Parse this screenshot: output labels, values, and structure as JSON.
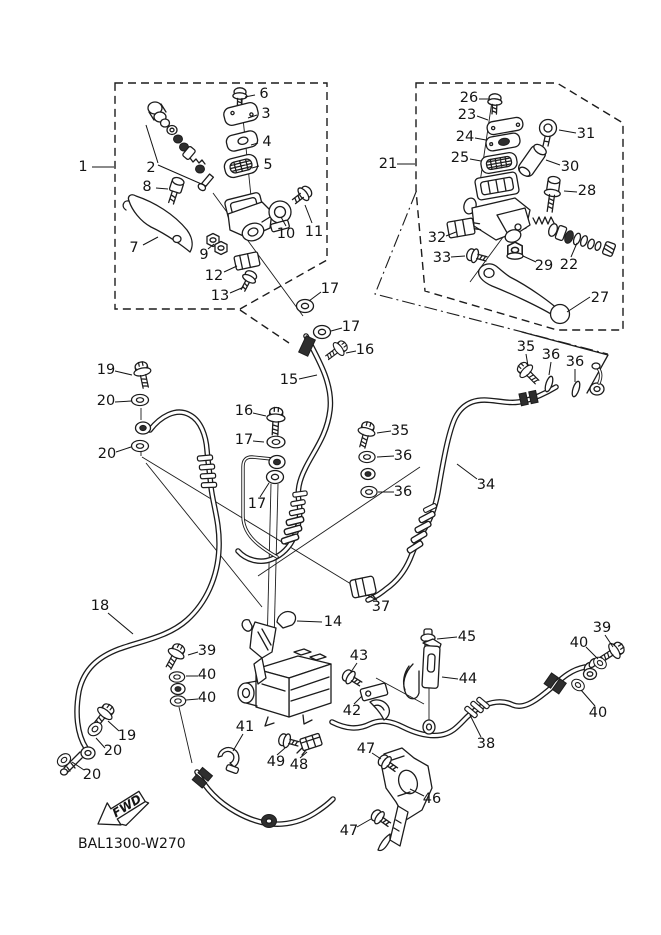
{
  "diagram": {
    "code_label": "BAL1300-W270",
    "fwd_arrow": {
      "label": "FWD"
    },
    "colors": {
      "background": "#ffffff",
      "line": "#1c1c1c",
      "text": "#141414"
    },
    "part_labels": [
      {
        "text": "1",
        "x": 83,
        "y": 167,
        "l": [
          [
            92,
            167,
            114,
            167
          ]
        ]
      },
      {
        "text": "2",
        "x": 151,
        "y": 168,
        "l": [
          [
            158,
            163,
            146,
            125
          ],
          [
            158,
            165,
            206,
            186
          ]
        ]
      },
      {
        "text": "3",
        "x": 266,
        "y": 114,
        "l": [
          [
            257,
            115,
            248,
            118
          ]
        ]
      },
      {
        "text": "4",
        "x": 267,
        "y": 142,
        "l": [
          [
            258,
            143,
            251,
            145
          ]
        ]
      },
      {
        "text": "5",
        "x": 268,
        "y": 165,
        "l": [
          [
            259,
            166,
            252,
            168
          ]
        ]
      },
      {
        "text": "6",
        "x": 264,
        "y": 94,
        "l": [
          [
            255,
            95,
            245,
            97
          ]
        ]
      },
      {
        "text": "7",
        "x": 134,
        "y": 248,
        "l": [
          [
            143,
            245,
            158,
            237
          ]
        ]
      },
      {
        "text": "8",
        "x": 147,
        "y": 187,
        "l": [
          [
            156,
            188,
            168,
            189
          ]
        ]
      },
      {
        "text": "9",
        "x": 204,
        "y": 255,
        "l": [
          [
            208,
            249,
            214,
            244
          ]
        ]
      },
      {
        "text": "10",
        "x": 286,
        "y": 234,
        "l": [
          [
            286,
            226,
            281,
            217
          ]
        ]
      },
      {
        "text": "11",
        "x": 314,
        "y": 232,
        "l": [
          [
            312,
            223,
            305,
            205
          ]
        ]
      },
      {
        "text": "12",
        "x": 214,
        "y": 276,
        "l": [
          [
            224,
            272,
            237,
            266
          ]
        ]
      },
      {
        "text": "13",
        "x": 220,
        "y": 296,
        "l": [
          [
            230,
            293,
            244,
            287
          ]
        ]
      },
      {
        "text": "17",
        "x": 330,
        "y": 289,
        "l": [
          [
            321,
            292,
            309,
            301
          ]
        ]
      },
      {
        "text": "17",
        "x": 351,
        "y": 327,
        "l": [
          [
            342,
            328,
            331,
            331
          ]
        ]
      },
      {
        "text": "16",
        "x": 365,
        "y": 350,
        "l": [
          [
            356,
            351,
            346,
            353
          ]
        ]
      },
      {
        "text": "15",
        "x": 289,
        "y": 380,
        "l": [
          [
            299,
            379,
            317,
            375
          ]
        ]
      },
      {
        "text": "21",
        "x": 388,
        "y": 164,
        "l": [
          [
            397,
            164,
            415,
            164
          ]
        ]
      },
      {
        "text": "26",
        "x": 469,
        "y": 98,
        "l": [
          [
            479,
            99,
            489,
            99
          ]
        ]
      },
      {
        "text": "23",
        "x": 467,
        "y": 115,
        "l": [
          [
            477,
            116,
            488,
            120
          ]
        ]
      },
      {
        "text": "24",
        "x": 465,
        "y": 137,
        "l": [
          [
            475,
            138,
            486,
            140
          ]
        ]
      },
      {
        "text": "25",
        "x": 460,
        "y": 158,
        "l": [
          [
            470,
            159,
            481,
            161
          ]
        ]
      },
      {
        "text": "31",
        "x": 586,
        "y": 134,
        "l": [
          [
            576,
            133,
            559,
            130
          ]
        ]
      },
      {
        "text": "30",
        "x": 570,
        "y": 167,
        "l": [
          [
            560,
            165,
            546,
            160
          ]
        ]
      },
      {
        "text": "28",
        "x": 587,
        "y": 191,
        "l": [
          [
            577,
            192,
            564,
            191
          ]
        ]
      },
      {
        "text": "32",
        "x": 437,
        "y": 238,
        "l": [
          [
            446,
            236,
            456,
            232
          ]
        ]
      },
      {
        "text": "33",
        "x": 442,
        "y": 258,
        "l": [
          [
            451,
            257,
            465,
            256
          ]
        ]
      },
      {
        "text": "29",
        "x": 544,
        "y": 266,
        "l": [
          [
            536,
            262,
            523,
            256
          ]
        ]
      },
      {
        "text": "22",
        "x": 569,
        "y": 265,
        "l": [
          [
            571,
            257,
            577,
            243
          ]
        ]
      },
      {
        "text": "27",
        "x": 600,
        "y": 298,
        "l": [
          [
            590,
            297,
            567,
            312
          ]
        ]
      },
      {
        "text": "35",
        "x": 526,
        "y": 347,
        "l": [
          [
            526,
            354,
            528,
            366
          ]
        ]
      },
      {
        "text": "36",
        "x": 551,
        "y": 355,
        "l": [
          [
            551,
            362,
            549,
            375
          ]
        ]
      },
      {
        "text": "36",
        "x": 575,
        "y": 362,
        "l": [
          [
            575,
            369,
            575,
            382
          ]
        ]
      },
      {
        "text": "34",
        "x": 486,
        "y": 485,
        "l": [
          [
            477,
            479,
            457,
            464
          ]
        ]
      },
      {
        "text": "19",
        "x": 106,
        "y": 370,
        "l": [
          [
            115,
            371,
            132,
            375
          ]
        ]
      },
      {
        "text": "20",
        "x": 106,
        "y": 401,
        "l": [
          [
            115,
            402,
            132,
            401
          ]
        ]
      },
      {
        "text": "20",
        "x": 107,
        "y": 454,
        "l": [
          [
            116,
            452,
            131,
            447
          ]
        ]
      },
      {
        "text": "16",
        "x": 244,
        "y": 411,
        "l": [
          [
            253,
            413,
            266,
            416
          ]
        ]
      },
      {
        "text": "17",
        "x": 244,
        "y": 440,
        "l": [
          [
            253,
            441,
            264,
            442
          ]
        ]
      },
      {
        "text": "17",
        "x": 257,
        "y": 504,
        "l": [
          [
            260,
            497,
            269,
            483
          ]
        ]
      },
      {
        "text": "35",
        "x": 400,
        "y": 431,
        "l": [
          [
            391,
            431,
            377,
            433
          ]
        ]
      },
      {
        "text": "36",
        "x": 403,
        "y": 456,
        "l": [
          [
            394,
            456,
            377,
            457
          ]
        ]
      },
      {
        "text": "36",
        "x": 403,
        "y": 492,
        "l": [
          [
            394,
            492,
            378,
            492
          ]
        ]
      },
      {
        "text": "18",
        "x": 100,
        "y": 606,
        "l": [
          [
            108,
            613,
            133,
            634
          ]
        ]
      },
      {
        "text": "37",
        "x": 381,
        "y": 607,
        "l": [
          [
            377,
            600,
            367,
            595
          ]
        ]
      },
      {
        "text": "14",
        "x": 333,
        "y": 622,
        "l": [
          [
            322,
            622,
            297,
            621
          ]
        ]
      },
      {
        "text": "39",
        "x": 207,
        "y": 651,
        "l": [
          [
            198,
            652,
            188,
            655
          ]
        ]
      },
      {
        "text": "40",
        "x": 207,
        "y": 675,
        "l": [
          [
            198,
            676,
            186,
            676
          ]
        ]
      },
      {
        "text": "40",
        "x": 207,
        "y": 698,
        "l": [
          [
            198,
            699,
            186,
            700
          ]
        ]
      },
      {
        "text": "19",
        "x": 127,
        "y": 736,
        "l": [
          [
            119,
            731,
            108,
            721
          ]
        ]
      },
      {
        "text": "20",
        "x": 113,
        "y": 751,
        "l": [
          [
            105,
            748,
            96,
            738
          ]
        ]
      },
      {
        "text": "20",
        "x": 92,
        "y": 775,
        "l": [
          [
            84,
            770,
            72,
            762
          ]
        ]
      },
      {
        "text": "41",
        "x": 245,
        "y": 727,
        "l": [
          [
            243,
            734,
            233,
            751
          ]
        ]
      },
      {
        "text": "49",
        "x": 276,
        "y": 762,
        "l": [
          [
            277,
            755,
            285,
            748
          ]
        ]
      },
      {
        "text": "48",
        "x": 299,
        "y": 765,
        "l": [
          [
            300,
            758,
            307,
            752
          ]
        ]
      },
      {
        "text": "43",
        "x": 359,
        "y": 656,
        "l": [
          [
            357,
            663,
            351,
            672
          ]
        ]
      },
      {
        "text": "42",
        "x": 352,
        "y": 711,
        "l": [
          [
            354,
            704,
            362,
            696
          ]
        ]
      },
      {
        "text": "45",
        "x": 467,
        "y": 637,
        "l": [
          [
            457,
            637,
            437,
            639
          ]
        ]
      },
      {
        "text": "44",
        "x": 468,
        "y": 679,
        "l": [
          [
            458,
            679,
            442,
            677
          ]
        ]
      },
      {
        "text": "47",
        "x": 366,
        "y": 749,
        "l": [
          [
            372,
            753,
            381,
            759
          ]
        ]
      },
      {
        "text": "46",
        "x": 432,
        "y": 799,
        "l": [
          [
            424,
            796,
            410,
            789
          ]
        ]
      },
      {
        "text": "47",
        "x": 349,
        "y": 831,
        "l": [
          [
            357,
            827,
            371,
            819
          ]
        ]
      },
      {
        "text": "39",
        "x": 602,
        "y": 628,
        "l": [
          [
            605,
            635,
            613,
            647
          ]
        ]
      },
      {
        "text": "40",
        "x": 579,
        "y": 643,
        "l": [
          [
            586,
            647,
            598,
            659
          ]
        ]
      },
      {
        "text": "40",
        "x": 598,
        "y": 713,
        "l": [
          [
            595,
            706,
            581,
            690
          ]
        ]
      },
      {
        "text": "38",
        "x": 486,
        "y": 744,
        "l": [
          [
            481,
            737,
            470,
            715
          ]
        ]
      }
    ]
  }
}
